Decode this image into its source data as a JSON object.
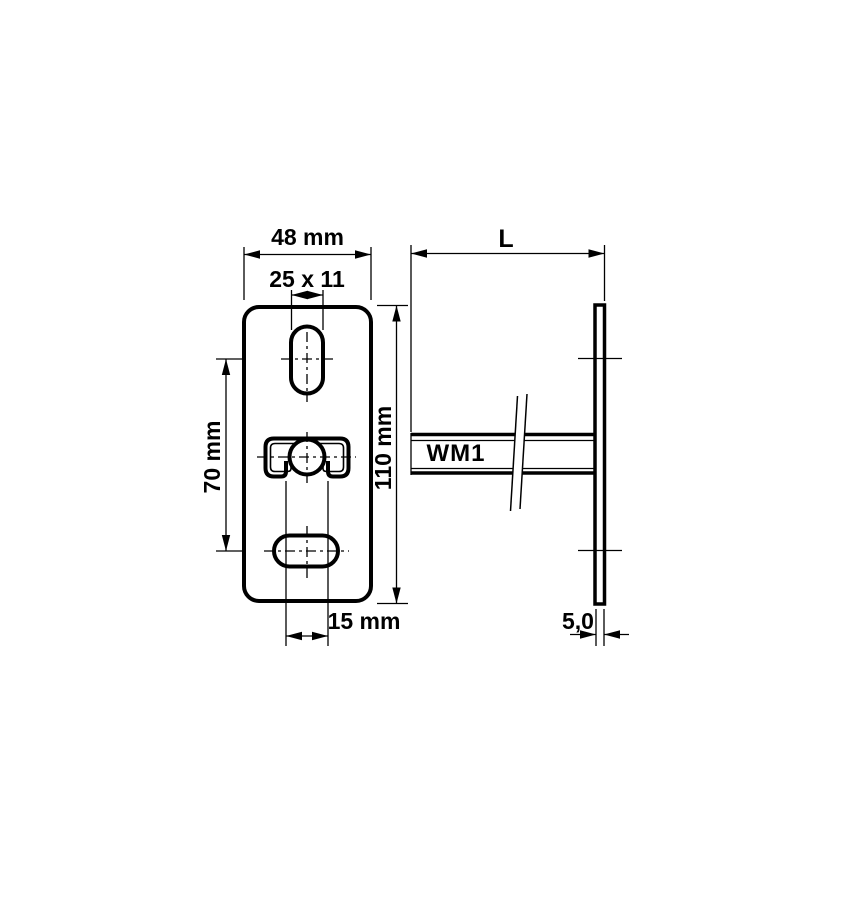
{
  "drawing": {
    "front_view": {
      "dim_width": "48 mm",
      "dim_slot": "25 x 11",
      "dim_hole_spacing": "70 mm",
      "dim_height": "110 mm",
      "dim_opening": "15 mm"
    },
    "side_view": {
      "dim_length": "L",
      "rail_label": "WM1",
      "dim_thickness": "5,0"
    },
    "colors": {
      "line": "#000000",
      "background": "#ffffff"
    }
  }
}
